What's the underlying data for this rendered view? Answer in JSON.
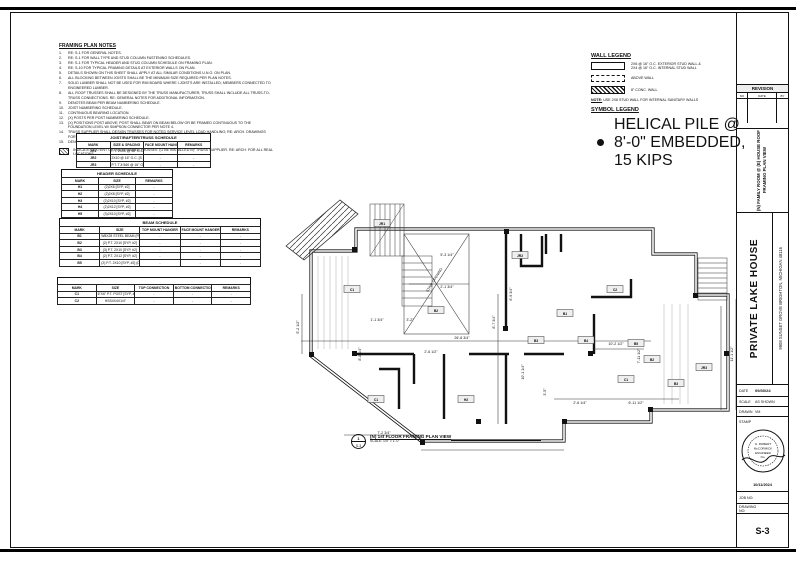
{
  "sheet": {
    "number": "S-3",
    "job_label": "JOB NO:",
    "drawing_label": "DRAWING NO:"
  },
  "title_block": {
    "revision": {
      "title": "REVISION",
      "columns": [
        "NO",
        "DATE",
        "BY"
      ]
    },
    "sheet_title": "(N) FAMILY ROOM @ (E) HOUSE ROOF\nFRAMING PLAN VIEW",
    "project_name": "PRIVATE LAKE HOUSE",
    "project_address": "9908 SUNSET GROVE BRIGHTON, MICHIGAN 48116",
    "date_label": "DATE",
    "date_value": "09/30/24",
    "scale_label": "SCALE",
    "scale_value": "AS SHOWN",
    "drawn_label": "DRAWN",
    "drawn_value": "VM",
    "stamp_label": "STAMP",
    "stamp_lines": [
      "G. ROBERT",
      "McCORMICK",
      "ENGINEER",
      "No."
    ],
    "seal_ring_text": "STATE OF MICHIGAN PROFESSIONAL ENGINEER",
    "stamp_date": "10/11/2024"
  },
  "notes": {
    "title": "FRAMING PLAN NOTES",
    "items": [
      "RE: S-1 FOR GENERAL NOTES.",
      "RE: S-1 FOR WALL TYPE AND STUD COLUMN FASTENING SCHEDULES.",
      "RE: S-1 FOR TYPICAL HEADER AND STUD COLUMN SCHEDULE ON FRAMING PLAN.",
      "RE: S-10 FOR TYPICAL FRAMING DETAILS AT EXTERIOR WALLS ON PLAN.",
      "DETAILS SHOWN ON THIS SHEET SHALL APPLY AT ALL SIMILAR CONDITIONS U.N.O. ON PLAN.",
      "ALL BLOCKING BETWEEN JOISTS SHALL BE THE MINIMUM SIZE REQUIRED PER PLAN NOTES.",
      "SOLID LUMBER SHALL NOT BE USED FOR RIM BOARD WHERE I-JOISTS ARE INSTALLED; MEMBERS CONNECTED TO ENGINEERED LUMBER.",
      "ALL ROOF TRUSSES SHALL BE DESIGNED BY THE TRUSS MANUFACTURER; TRUSS SHALL INCLUDE ALL TRUSS-TO-TRUSS CONNECTIONS. RE: GENERAL NOTES FOR ADDITIONAL INFORMATION.",
      "DENOTES BEAM PER BEAM NUMBERING SCHEDULE.",
      "JOIST NUMBERING SCHEDULE.",
      "CONTINUOUS BEARING LOCATION.",
      "(X) POSTS PER POST NUMBERING SCHEDULE.",
      "(X) POSITIONS POST ABOVE; POST SHALL BEAR ON BEAM BELOW OR BE FRAMED CONTINUOUS TO THE FOUNDATION LEVEL W/ SIMPSON CONNECTOR PER NOTE 4.",
      "TRUSS SUPPLIER SHALL DESIGN TRUSSES FOR NOTED SERVICE LEVEL LOAD HANDLING; RE: ARCH. DRAWINGS FOR LOCATIONS.",
      "DENOTES VERTICAL STEP IN T.O. SHEATHING/SLAB ELEVATION."
    ],
    "hatch_note": "INDICATES EXTENT OF OVERFRAMED TRUSSES TO BE INSTALLED BY TRUSS SUPPLIER. RE: ARCH. FOR ALL REAL LOCATIONS."
  },
  "schedules": {
    "joist": {
      "title": "JOIST/RAFTER/TRUSS SCHEDULE",
      "columns": [
        "MARK",
        "SIZE & SPACING",
        "FACE MOUNT HANGER",
        "REMARKS"
      ],
      "rows": [
        [
          "JR1",
          "P.T. 2X10 @ 16\" O.C. [SYP, #2]",
          "-",
          "-"
        ],
        [
          "JR2",
          "2X10 @ 16\" O.C. [S.P.F., #2]",
          "-",
          "-"
        ],
        [
          "JR3",
          "P.T. TJI 560 @ 16\" O.C. [SYP, #2]",
          "-",
          "-"
        ]
      ]
    },
    "header": {
      "title": "HEADER SCHEDULE",
      "columns": [
        "MARK",
        "SIZE",
        "REMARKS"
      ],
      "rows": [
        [
          "H1",
          "(2)2X6 [SYP, #2]",
          "-"
        ],
        [
          "H2",
          "(2)2X8 [SYP, #2]",
          "-"
        ],
        [
          "H3",
          "(2)2X10 [SYP, #2]",
          "-"
        ],
        [
          "H4",
          "(2)2X12 [SYP, #2]",
          "-"
        ],
        [
          "H5",
          "(3)2X10 [SYP, #2]",
          "-"
        ],
        [
          "H6",
          "(3)2X12 [SYP, #2]",
          "-"
        ],
        [
          "H7",
          "3-1/2\"X9-1/4\" LVL",
          "-"
        ]
      ]
    },
    "beam": {
      "title": "BEAM SCHEDULE",
      "columns": [
        "MARK",
        "SIZE",
        "TOP MOUNT HANGER",
        "FACE MOUNT HANGER",
        "REMARKS"
      ],
      "rows": [
        [
          "B1",
          "W8X28 STEEL BEAM (FLUSH)",
          "-",
          "-",
          "-"
        ],
        [
          "B2",
          "(2) P.T. 2X10 [SYP, #2]",
          "-",
          "-",
          "-"
        ],
        [
          "B3",
          "(3) P.T. 2X10 [SYP, #2]",
          "-",
          "-",
          "-"
        ],
        [
          "B4",
          "(2) P.T. 2X12 [SYP, #2]",
          "-",
          "-",
          "-"
        ],
        [
          "B5",
          "(2) P.T. 2X10 [SYP, #2] (DROPPED)",
          "-",
          "-",
          "-"
        ]
      ]
    },
    "column": {
      "title": "",
      "columns": [
        "MARK",
        "SIZE",
        "TOP CONNECTION",
        "BOTTOM CONNECTION",
        "REMARKS"
      ],
      "rows": [
        [
          "C1",
          "6\"X6\" P.T. POST [SYP, #2]",
          "-",
          "-",
          "-"
        ],
        [
          "C2",
          "HSS4X4X1/4\"",
          "-",
          "-",
          "-"
        ]
      ]
    }
  },
  "wall_legend": {
    "title": "WALL LEGEND",
    "items": [
      {
        "swatch": "solid",
        "label": "2X6 @ 16\" O.C. EXTERIOR STUD WALL &\n2X4 @ 16\" O.C. INTERNAL STUD WALL"
      },
      {
        "swatch": "dashed",
        "label": "ABOVE WALL"
      },
      {
        "swatch": "hatched",
        "label": "8\" CONC. WALL"
      }
    ],
    "note_label": "NOTE:",
    "note": "USE 2X6 STUD WALL FOR INTERNAL SANITARY WALLS"
  },
  "symbol_legend": {
    "title": "SYMBOL LEGEND",
    "items": [
      {
        "symbol": "filled-circle",
        "label": "HELICAL PILE @ 8'-0\" EMBEDDED, 15 KIPS"
      }
    ]
  },
  "plan": {
    "caption": "(N) 1st FLOOR FRAMING PLAN VIEW",
    "scale": "SCALE: 1/4\" = 1'-0\"",
    "bubble_top": "1",
    "bubble_bottom": "S-3",
    "stair_opening_label": "STAIR OPENING",
    "dimensions": [
      {
        "t": "26'-8 3/4\"",
        "x": 178,
        "y": 145,
        "r": 0
      },
      {
        "t": "10'-2 1/2\"",
        "x": 332,
        "y": 151,
        "r": 0
      },
      {
        "t": "7'-11 1/2\"",
        "x": 356,
        "y": 162,
        "r": 1
      },
      {
        "t": "11'-1 1/2\"",
        "x": 449,
        "y": 160,
        "r": 1
      },
      {
        "t": "8'-7 3/4\"",
        "x": 211,
        "y": 128,
        "r": 1
      },
      {
        "t": "5'-2 1/2\"",
        "x": 15,
        "y": 133,
        "r": 1
      },
      {
        "t": "8'-8 1/4\"",
        "x": 77,
        "y": 160,
        "r": 1
      },
      {
        "t": "7'-2 3/4\"",
        "x": 100,
        "y": 240,
        "r": 0
      },
      {
        "t": "2'-6 1/4\"",
        "x": 296,
        "y": 210,
        "r": 0
      },
      {
        "t": "6'-11 1/2\"",
        "x": 352,
        "y": 210,
        "r": 0
      },
      {
        "t": "5'-3 1/4\"",
        "x": 163,
        "y": 62,
        "r": 0
      },
      {
        "t": "2'-1 3/4\"",
        "x": 163,
        "y": 94,
        "r": 0
      },
      {
        "t": "3'-2\"",
        "x": 126,
        "y": 127,
        "r": 0
      },
      {
        "t": "1'-1 3/4\"",
        "x": 93,
        "y": 127,
        "r": 0
      },
      {
        "t": "2'-6 1/2\"",
        "x": 147,
        "y": 159,
        "r": 0
      },
      {
        "t": "3'-5\"",
        "x": 262,
        "y": 198,
        "r": 1
      },
      {
        "t": "10'-1 1/4\"",
        "x": 240,
        "y": 178,
        "r": 1
      },
      {
        "t": "6'-9 3/4\"",
        "x": 228,
        "y": 100,
        "r": 1
      }
    ],
    "markers": [
      {
        "l": "C1",
        "x": 68,
        "y": 96
      },
      {
        "l": "JR1",
        "x": 98,
        "y": 30
      },
      {
        "l": "B2",
        "x": 152,
        "y": 117
      },
      {
        "l": "JR2",
        "x": 236,
        "y": 62
      },
      {
        "l": "B3",
        "x": 252,
        "y": 147
      },
      {
        "l": "B4",
        "x": 302,
        "y": 147
      },
      {
        "l": "C2",
        "x": 331,
        "y": 96
      },
      {
        "l": "B5",
        "x": 352,
        "y": 150
      },
      {
        "l": "B2",
        "x": 368,
        "y": 166
      },
      {
        "l": "C1",
        "x": 342,
        "y": 186
      },
      {
        "l": "B3",
        "x": 392,
        "y": 190
      },
      {
        "l": "JR3",
        "x": 420,
        "y": 174
      },
      {
        "l": "H2",
        "x": 182,
        "y": 206
      },
      {
        "l": "C1",
        "x": 92,
        "y": 206
      },
      {
        "l": "B1",
        "x": 281,
        "y": 120
      }
    ]
  }
}
